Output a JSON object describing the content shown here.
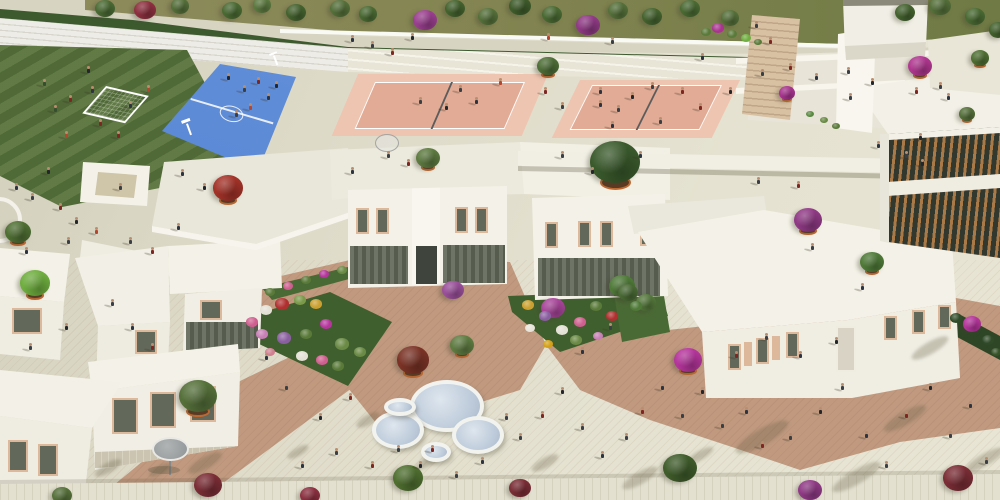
{
  "scene": {
    "type": "aerial-architectural-rendering",
    "subject": "school campus with sports courts, courtyard buildings, gardens and plazas"
  },
  "palette": {
    "plaza": "#dcd8c6",
    "plaza_light": "#e7e4d3",
    "brick": "#c0997f",
    "field_green": "#55703a",
    "court_blue": "#4e80cf",
    "court_blue_light": "#6b95dc",
    "vball_inner": "#e2ab96",
    "vball_apron": "#eec5b1",
    "hedge": "#3d5a2f",
    "olive_bed": "#848552",
    "building_white": "#f4f2e8",
    "building_shade": "#dbd8ca",
    "louver_brown": "#a97a48",
    "window_glass": "#62685a",
    "frame_tan": "#ddb89b",
    "canopy_glass": "#bac8d8",
    "terracotta": "#c06a32",
    "garden_green": "#4a6a35"
  },
  "sprites": {
    "people_colors": [
      "#2b3440",
      "#7d2622",
      "#1f3d6b",
      "#3a3f45",
      "#8a6a4a",
      "#364d2e",
      "#b5452c",
      "#6b7480",
      "#c9b08e",
      "#23262b"
    ],
    "trees": [
      [
        105,
        8,
        10,
        "#4a6a33",
        0
      ],
      [
        145,
        10,
        11,
        "#8e3040",
        0
      ],
      [
        180,
        6,
        9,
        "#55703a",
        0
      ],
      [
        232,
        10,
        10,
        "#4a6a33",
        0
      ],
      [
        262,
        5,
        9,
        "#5c7a40",
        0
      ],
      [
        296,
        12,
        10,
        "#44622e",
        0
      ],
      [
        340,
        8,
        10,
        "#55703a",
        0
      ],
      [
        368,
        14,
        9,
        "#4a6a33",
        0
      ],
      [
        425,
        20,
        12,
        "#9a3f8f",
        0
      ],
      [
        455,
        8,
        10,
        "#44622e",
        0
      ],
      [
        488,
        16,
        10,
        "#55703a",
        0
      ],
      [
        520,
        6,
        11,
        "#3f5c2b",
        0
      ],
      [
        552,
        14,
        10,
        "#4a6a33",
        0
      ],
      [
        588,
        25,
        12,
        "#8f3a85",
        0
      ],
      [
        618,
        10,
        10,
        "#55703a",
        0
      ],
      [
        652,
        16,
        10,
        "#44622e",
        0
      ],
      [
        690,
        8,
        10,
        "#4a6a33",
        0
      ],
      [
        730,
        18,
        9,
        "#55703a",
        0
      ],
      [
        905,
        12,
        10,
        "#44622e",
        0
      ],
      [
        940,
        6,
        11,
        "#55703a",
        0
      ],
      [
        975,
        16,
        10,
        "#4a6a33",
        0
      ],
      [
        998,
        30,
        9,
        "#44622e",
        0
      ],
      [
        18,
        232,
        13,
        "#4f6f33",
        1
      ],
      [
        35,
        283,
        15,
        "#6fae3f",
        1
      ],
      [
        228,
        188,
        15,
        "#a23228",
        1
      ],
      [
        428,
        158,
        12,
        "#5d7a40",
        1
      ],
      [
        548,
        66,
        11,
        "#4e6e37",
        1
      ],
      [
        615,
        162,
        25,
        "#3a5a2c",
        1
      ],
      [
        808,
        220,
        14,
        "#8f3a85",
        1
      ],
      [
        872,
        262,
        12,
        "#4f7a38",
        1
      ],
      [
        920,
        66,
        12,
        "#b03790",
        1
      ],
      [
        967,
        114,
        8,
        "#55703a",
        1
      ],
      [
        787,
        93,
        8,
        "#a8348f",
        1
      ],
      [
        198,
        396,
        19,
        "#55703a",
        1
      ],
      [
        462,
        345,
        12,
        "#5f7c42",
        1
      ],
      [
        413,
        360,
        16,
        "#7a3326",
        1
      ],
      [
        688,
        360,
        14,
        "#b5359c",
        1
      ],
      [
        980,
        58,
        9,
        "#4f6f33",
        1
      ],
      [
        553,
        308,
        12,
        "#a8459a",
        0
      ],
      [
        622,
        286,
        13,
        "#4f7a38",
        0
      ],
      [
        453,
        290,
        11,
        "#9a4f9a",
        0
      ],
      [
        628,
        292,
        10,
        "#4a6a35",
        0
      ],
      [
        646,
        302,
        10,
        "#55783c",
        0
      ],
      [
        208,
        485,
        14,
        "#7a2d35",
        0
      ],
      [
        310,
        495,
        10,
        "#8c3040",
        0
      ],
      [
        408,
        478,
        15,
        "#4f6f30",
        0
      ],
      [
        520,
        488,
        11,
        "#7a2d35",
        0
      ],
      [
        680,
        468,
        17,
        "#3f5c2b",
        0
      ],
      [
        810,
        490,
        12,
        "#8f3a85",
        0
      ],
      [
        958,
        478,
        15,
        "#7a2d35",
        0
      ],
      [
        62,
        495,
        10,
        "#55703a",
        0
      ],
      [
        972,
        324,
        9,
        "#b5359c",
        0
      ]
    ],
    "flowers": [
      [
        252,
        322,
        6,
        "#cf5f8f"
      ],
      [
        266,
        310,
        6,
        "#e3e0d4"
      ],
      [
        282,
        304,
        7,
        "#b03030"
      ],
      [
        300,
        300,
        6,
        "#7a9a4a"
      ],
      [
        316,
        304,
        6,
        "#caa030"
      ],
      [
        262,
        334,
        6,
        "#c77fb5"
      ],
      [
        284,
        338,
        7,
        "#8a5fa0"
      ],
      [
        306,
        334,
        6,
        "#5a7a3a"
      ],
      [
        326,
        324,
        6,
        "#b5359c"
      ],
      [
        342,
        344,
        7,
        "#6a8a45"
      ],
      [
        302,
        356,
        6,
        "#e3e0d4"
      ],
      [
        322,
        360,
        6,
        "#cf5f8f"
      ],
      [
        338,
        366,
        6,
        "#5a7a3a"
      ],
      [
        270,
        352,
        5,
        "#d08090"
      ],
      [
        360,
        352,
        6,
        "#6a8a45"
      ],
      [
        270,
        292,
        5,
        "#5a7a3a"
      ],
      [
        288,
        286,
        5,
        "#cf5f8f"
      ],
      [
        306,
        280,
        5,
        "#5a7a3a"
      ],
      [
        324,
        274,
        5,
        "#b5359c"
      ],
      [
        342,
        270,
        5,
        "#6a8a45"
      ],
      [
        528,
        305,
        6,
        "#caa030"
      ],
      [
        545,
        316,
        6,
        "#8a5fa0"
      ],
      [
        562,
        330,
        6,
        "#e3e0d4"
      ],
      [
        580,
        322,
        6,
        "#cf5f8f"
      ],
      [
        596,
        306,
        6,
        "#5a7a3a"
      ],
      [
        612,
        316,
        6,
        "#b03030"
      ],
      [
        576,
        340,
        6,
        "#6a8a45"
      ],
      [
        548,
        344,
        5,
        "#d4a017"
      ],
      [
        530,
        328,
        5,
        "#e8e4da"
      ],
      [
        598,
        336,
        5,
        "#c77fb5"
      ],
      [
        636,
        306,
        6,
        "#4f7a38"
      ],
      [
        706,
        32,
        5,
        "#5a7a3a"
      ],
      [
        718,
        28,
        6,
        "#a8348f"
      ],
      [
        732,
        34,
        5,
        "#5a7a3a"
      ],
      [
        746,
        38,
        5,
        "#6fae3f"
      ],
      [
        758,
        42,
        4,
        "#5a7a3a"
      ],
      [
        810,
        114,
        4,
        "#5a8a42"
      ],
      [
        824,
        120,
        4,
        "#6a8a45"
      ],
      [
        836,
        126,
        4,
        "#5a7a3a"
      ],
      [
        956,
        318,
        6,
        "#2f4a28"
      ],
      [
        988,
        340,
        6,
        "#2f4a28"
      ],
      [
        996,
        352,
        5,
        "#355228"
      ]
    ],
    "canopies": [
      [
        447,
        406,
        37,
        26
      ],
      [
        398,
        430,
        26,
        19
      ],
      [
        478,
        435,
        26,
        19
      ],
      [
        436,
        452,
        15,
        10
      ],
      [
        400,
        407,
        16,
        9
      ]
    ],
    "shadow_blobs": [
      [
        368,
        420,
        26,
        10
      ],
      [
        430,
        460,
        36,
        9
      ],
      [
        762,
        437,
        60,
        16
      ],
      [
        930,
        348,
        42,
        12
      ],
      [
        856,
        477,
        55,
        14
      ],
      [
        984,
        460,
        45,
        12
      ],
      [
        640,
        478,
        40,
        12
      ],
      [
        545,
        463,
        30,
        10
      ],
      [
        108,
        468,
        30,
        10
      ],
      [
        298,
        452,
        24,
        8
      ],
      [
        205,
        463,
        38,
        12
      ],
      [
        905,
        418,
        48,
        13
      ],
      [
        700,
        455,
        30,
        9
      ],
      [
        160,
        470,
        24,
        8
      ]
    ],
    "people": [
      [
        55,
        112,
        5
      ],
      [
        70,
        102,
        1
      ],
      [
        92,
        93,
        0
      ],
      [
        66,
        138,
        6
      ],
      [
        100,
        126,
        1
      ],
      [
        88,
        73,
        9
      ],
      [
        130,
        108,
        0
      ],
      [
        44,
        86,
        5
      ],
      [
        148,
        92,
        6
      ],
      [
        118,
        138,
        1
      ],
      [
        228,
        80,
        9
      ],
      [
        244,
        92,
        3
      ],
      [
        258,
        84,
        1
      ],
      [
        268,
        100,
        0
      ],
      [
        250,
        110,
        6
      ],
      [
        236,
        117,
        3
      ],
      [
        276,
        88,
        9
      ],
      [
        352,
        42,
        0
      ],
      [
        372,
        48,
        3
      ],
      [
        392,
        55,
        1
      ],
      [
        412,
        40,
        9
      ],
      [
        460,
        92,
        3
      ],
      [
        476,
        104,
        0
      ],
      [
        500,
        85,
        6
      ],
      [
        545,
        94,
        1
      ],
      [
        562,
        109,
        3
      ],
      [
        600,
        94,
        0
      ],
      [
        632,
        99,
        9
      ],
      [
        652,
        89,
        3
      ],
      [
        682,
        94,
        1
      ],
      [
        548,
        40,
        6
      ],
      [
        612,
        44,
        3
      ],
      [
        702,
        60,
        0
      ],
      [
        730,
        94,
        9
      ],
      [
        762,
        76,
        3
      ],
      [
        790,
        70,
        1
      ],
      [
        816,
        80,
        0
      ],
      [
        848,
        74,
        3
      ],
      [
        872,
        85,
        9
      ],
      [
        916,
        94,
        1
      ],
      [
        940,
        89,
        3
      ],
      [
        612,
        128,
        0
      ],
      [
        660,
        124,
        3
      ],
      [
        420,
        104,
        3
      ],
      [
        446,
        110,
        9
      ],
      [
        600,
        107,
        0
      ],
      [
        618,
        112,
        3
      ],
      [
        700,
        110,
        1
      ],
      [
        182,
        176,
        0
      ],
      [
        204,
        190,
        9
      ],
      [
        388,
        158,
        3
      ],
      [
        408,
        166,
        1
      ],
      [
        352,
        174,
        0
      ],
      [
        562,
        158,
        3
      ],
      [
        592,
        174,
        9
      ],
      [
        640,
        158,
        0
      ],
      [
        758,
        184,
        3
      ],
      [
        798,
        188,
        1
      ],
      [
        850,
        100,
        3
      ],
      [
        948,
        100,
        0
      ],
      [
        920,
        140,
        9
      ],
      [
        756,
        28,
        3
      ],
      [
        770,
        44,
        1
      ],
      [
        878,
        148,
        0
      ],
      [
        906,
        158,
        3
      ],
      [
        922,
        166,
        9
      ],
      [
        812,
        250,
        3
      ],
      [
        862,
        290,
        0
      ],
      [
        16,
        190,
        0
      ],
      [
        32,
        200,
        3
      ],
      [
        60,
        210,
        1
      ],
      [
        76,
        224,
        9
      ],
      [
        68,
        244,
        3
      ],
      [
        26,
        254,
        0
      ],
      [
        96,
        234,
        6
      ],
      [
        130,
        244,
        3
      ],
      [
        152,
        254,
        1
      ],
      [
        178,
        230,
        0
      ],
      [
        120,
        190,
        3
      ],
      [
        48,
        174,
        9
      ],
      [
        112,
        306,
        3
      ],
      [
        132,
        330,
        0
      ],
      [
        66,
        330,
        9
      ],
      [
        30,
        350,
        3
      ],
      [
        152,
        350,
        1
      ],
      [
        266,
        360,
        0
      ],
      [
        286,
        390,
        3
      ],
      [
        320,
        420,
        9
      ],
      [
        350,
        400,
        1
      ],
      [
        302,
        468,
        0
      ],
      [
        336,
        455,
        3
      ],
      [
        372,
        468,
        1
      ],
      [
        420,
        468,
        9
      ],
      [
        456,
        478,
        3
      ],
      [
        482,
        464,
        0
      ],
      [
        520,
        440,
        3
      ],
      [
        542,
        418,
        1
      ],
      [
        562,
        394,
        9
      ],
      [
        582,
        430,
        3
      ],
      [
        602,
        458,
        0
      ],
      [
        626,
        440,
        3
      ],
      [
        642,
        414,
        1
      ],
      [
        662,
        390,
        0
      ],
      [
        682,
        418,
        3
      ],
      [
        702,
        394,
        9
      ],
      [
        722,
        428,
        3
      ],
      [
        746,
        414,
        0
      ],
      [
        762,
        448,
        1
      ],
      [
        790,
        440,
        3
      ],
      [
        820,
        414,
        9
      ],
      [
        842,
        390,
        3
      ],
      [
        866,
        438,
        0
      ],
      [
        886,
        468,
        3
      ],
      [
        906,
        418,
        1
      ],
      [
        930,
        390,
        9
      ],
      [
        950,
        438,
        3
      ],
      [
        970,
        408,
        0
      ],
      [
        986,
        464,
        3
      ],
      [
        736,
        358,
        1
      ],
      [
        766,
        340,
        3
      ],
      [
        800,
        358,
        0
      ],
      [
        836,
        344,
        9
      ],
      [
        610,
        330,
        3
      ],
      [
        582,
        354,
        0
      ],
      [
        506,
        420,
        3
      ],
      [
        432,
        452,
        1
      ],
      [
        398,
        452,
        3
      ]
    ]
  }
}
